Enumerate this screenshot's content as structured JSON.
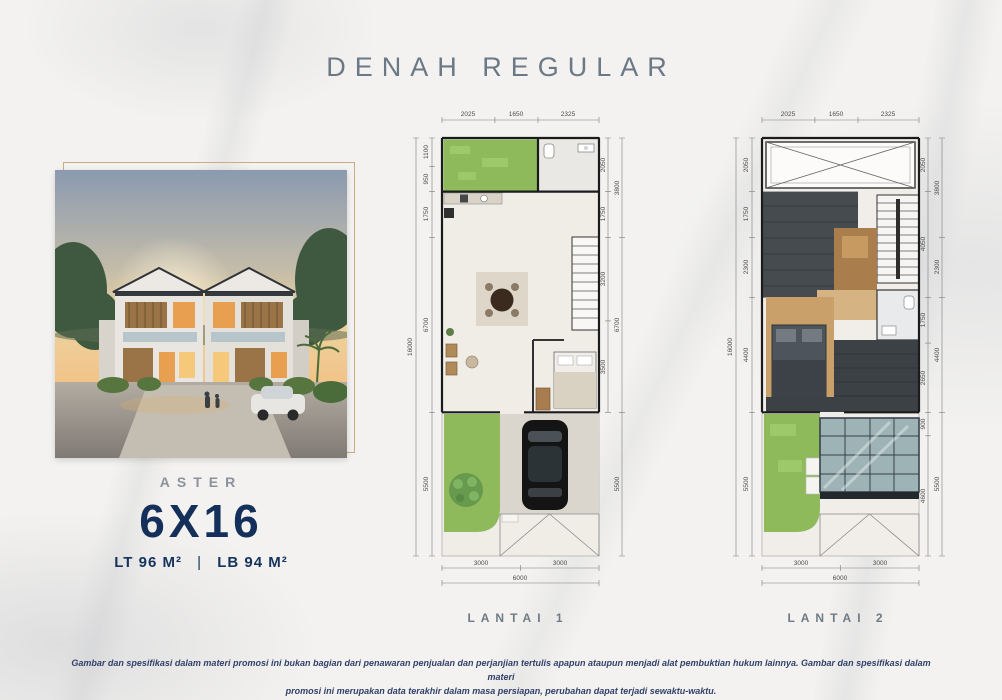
{
  "page": {
    "title": "DENAH REGULAR",
    "disclaimer_line1": "Gambar dan spesifikasi dalam materi promosi ini bukan bagian dari penawaran penjualan dan perjanjian tertulis apapun ataupun menjadi alat pembuktian hukum lainnya. Gambar dan spesifikasi dalam materi",
    "disclaimer_line2": "promosi ini merupakan data terakhir dalam masa persiapan, perubahan dapat terjadi sewaktu-waktu."
  },
  "product": {
    "series": "ASTER",
    "size": "6X16",
    "land_area": "LT 96 M²",
    "separator": "|",
    "building_area": "LB 94 M²"
  },
  "colors": {
    "brand_navy": "#16335c",
    "title_gray": "#6b7886",
    "frame_gold": "#c8ad82",
    "garden_green": "#8fba5c",
    "roof_dark": "#464b50",
    "wood_floor": "#c9a06a"
  },
  "plans": [
    {
      "label": "LANTAI 1",
      "dims_top": [
        "2025",
        "1650",
        "2325"
      ],
      "dims_left": [
        "1100",
        "950",
        "1750",
        "6700",
        "5500"
      ],
      "dims_left_total": "16000",
      "dims_right_inner": [
        "2050",
        "1750",
        "3200",
        "3500"
      ],
      "dims_right_outer": [
        "3800",
        "6700",
        "5500"
      ],
      "dims_bottom": [
        "3000",
        "3000"
      ],
      "dims_bottom_total": "6000"
    },
    {
      "label": "LANTAI 2",
      "dims_top": [
        "2025",
        "1650",
        "2325"
      ],
      "dims_left": [
        "2050",
        "1750",
        "2300",
        "4400",
        "5500"
      ],
      "dims_left_total": "16000",
      "dims_right_inner": [
        "2050",
        "4050",
        "1750",
        "2650",
        "900",
        "4600"
      ],
      "dims_right_outer": [
        "3800",
        "2300",
        "4400",
        "5500"
      ],
      "dims_bottom": [
        "3000",
        "3000"
      ],
      "dims_bottom_total": "6000"
    }
  ]
}
